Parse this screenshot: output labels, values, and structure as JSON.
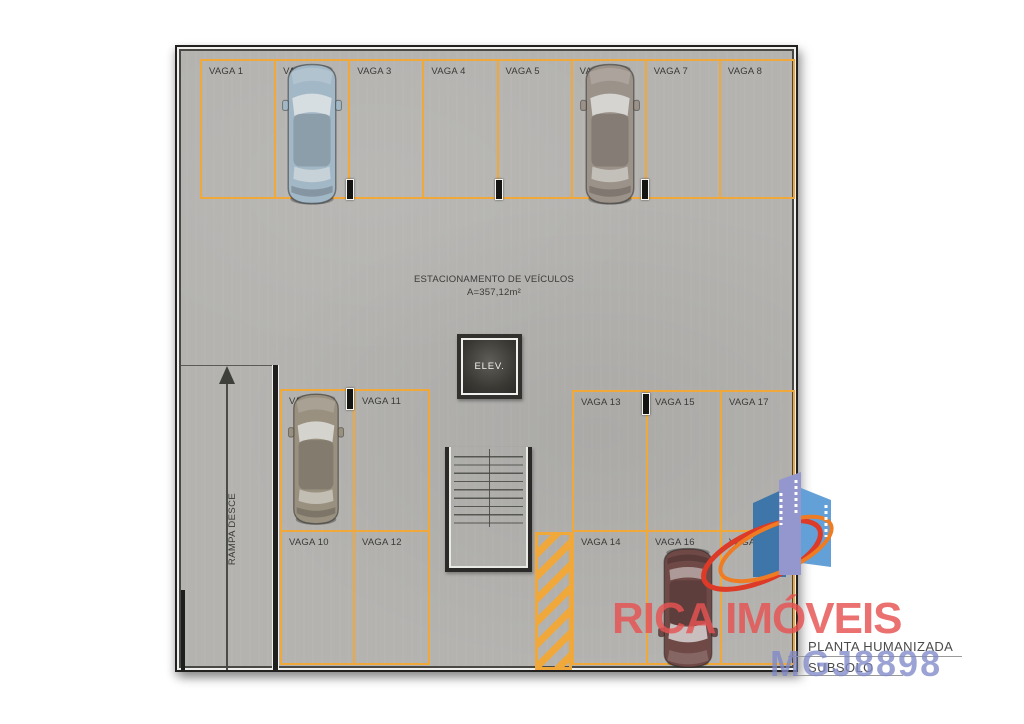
{
  "floor_plan": {
    "area_title": "ESTACIONAMENTO DE VEÍCULOS",
    "area_size": "A=357,12m²",
    "elevator": "ELEV.",
    "ramp": "RAMPA DESCE",
    "spots_top": [
      "VAGA 1",
      "VAGA 2",
      "VAGA 3",
      "VAGA 4",
      "VAGA 5",
      "VAGA 6",
      "VAGA 7",
      "VAGA 8"
    ],
    "spots_left_block": [
      "VAGA 9",
      "VAGA 11",
      "VAGA 10",
      "VAGA 12"
    ],
    "spots_right_block": [
      "VAGA 13",
      "VAGA 15",
      "VAGA 17",
      "VAGA 14",
      "VAGA 16",
      "VAGA 18"
    ],
    "cars": [
      {
        "spot": "VAGA 2",
        "color": "#a3b8c6"
      },
      {
        "spot": "VAGA 6",
        "color": "#9b9289"
      },
      {
        "spot": "VAGA 9",
        "color": "#99907f"
      },
      {
        "spot": "VAGA 16",
        "color": "#6e4946"
      }
    ],
    "marking_color": "#f0a83a"
  },
  "branding": {
    "agency": "RICA IMÓVEIS",
    "plan_type": "PLANTA HUMANIZADA",
    "floor": "SUBSOLO",
    "ref_code": "MGJ8898",
    "agency_color": "#e75252",
    "ref_color": "#8088c8",
    "logo_building_colors": [
      "#3e76aa",
      "#9397cd",
      "#64a0d8"
    ],
    "logo_swoosh_colors": [
      "#dd3a28",
      "#ef7b22"
    ]
  }
}
